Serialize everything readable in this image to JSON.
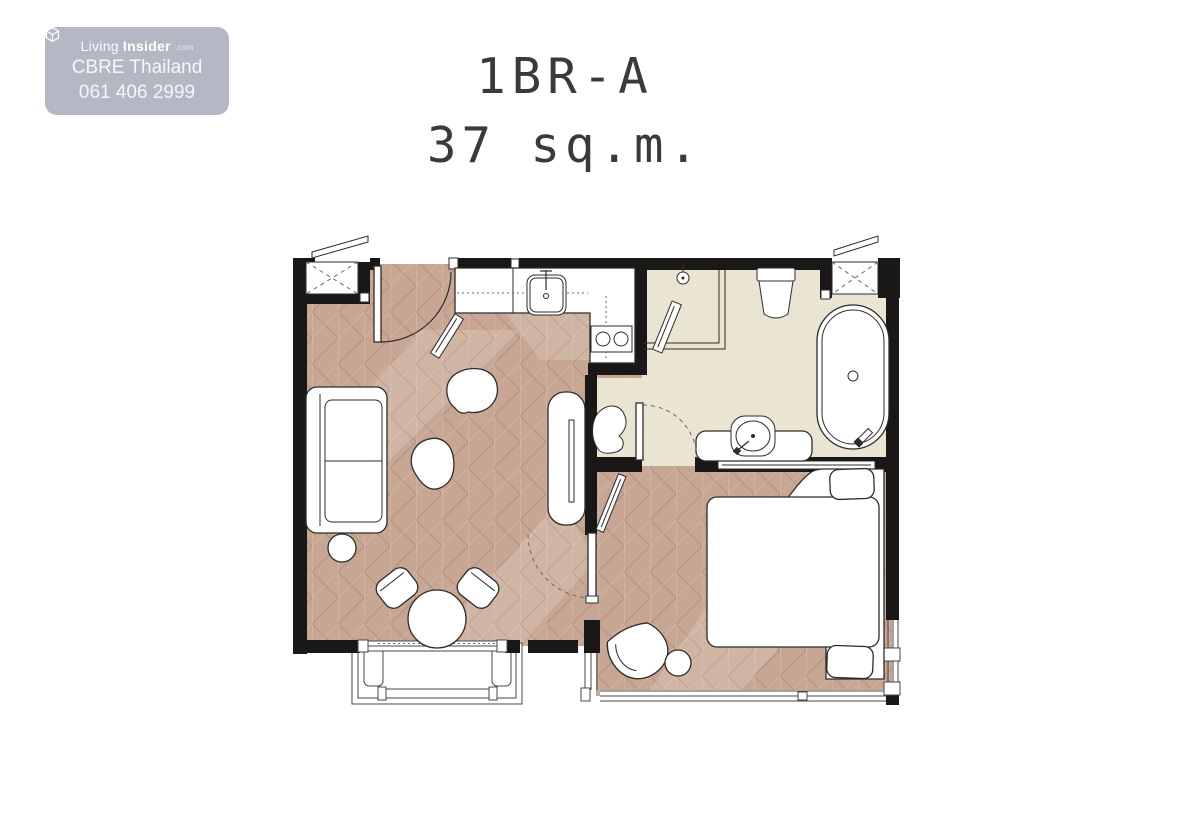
{
  "watermark": {
    "logo_icon": "cube-logo-icon",
    "logo_light": "Living",
    "logo_bold": "Insider",
    "logo_tld": ".com",
    "company": "CBRE Thailand",
    "phone": "061 406 2999"
  },
  "title": {
    "unit": "1BR-A",
    "area": "37 sq.m."
  },
  "colors": {
    "badge-bg": "#b5b7c4",
    "badge-text": "#ffffff",
    "title-text": "#3b3a38",
    "wall": "#1a1816",
    "wood-floor": "#c7a794",
    "bath-floor": "#eae4d3",
    "outline": "#2e2b28",
    "fixture-fill": "#ffffff"
  },
  "floorplan": {
    "rooms": [
      "entry",
      "kitchen",
      "living-dining",
      "bathroom",
      "bedroom",
      "balcony"
    ],
    "fixtures": [
      "entrance-door",
      "aircon-unit",
      "kitchen-counter",
      "kitchen-sink",
      "stove-burners",
      "sofa",
      "side-table",
      "pouf",
      "dining-table",
      "dining-chairs",
      "tv-console",
      "bedroom-door",
      "leaning-mirror",
      "bed",
      "pillows",
      "armchair",
      "ottoman",
      "bathroom-door",
      "shower",
      "toilet",
      "bathtub",
      "vanity-sink",
      "balcony-planters",
      "windows"
    ]
  }
}
